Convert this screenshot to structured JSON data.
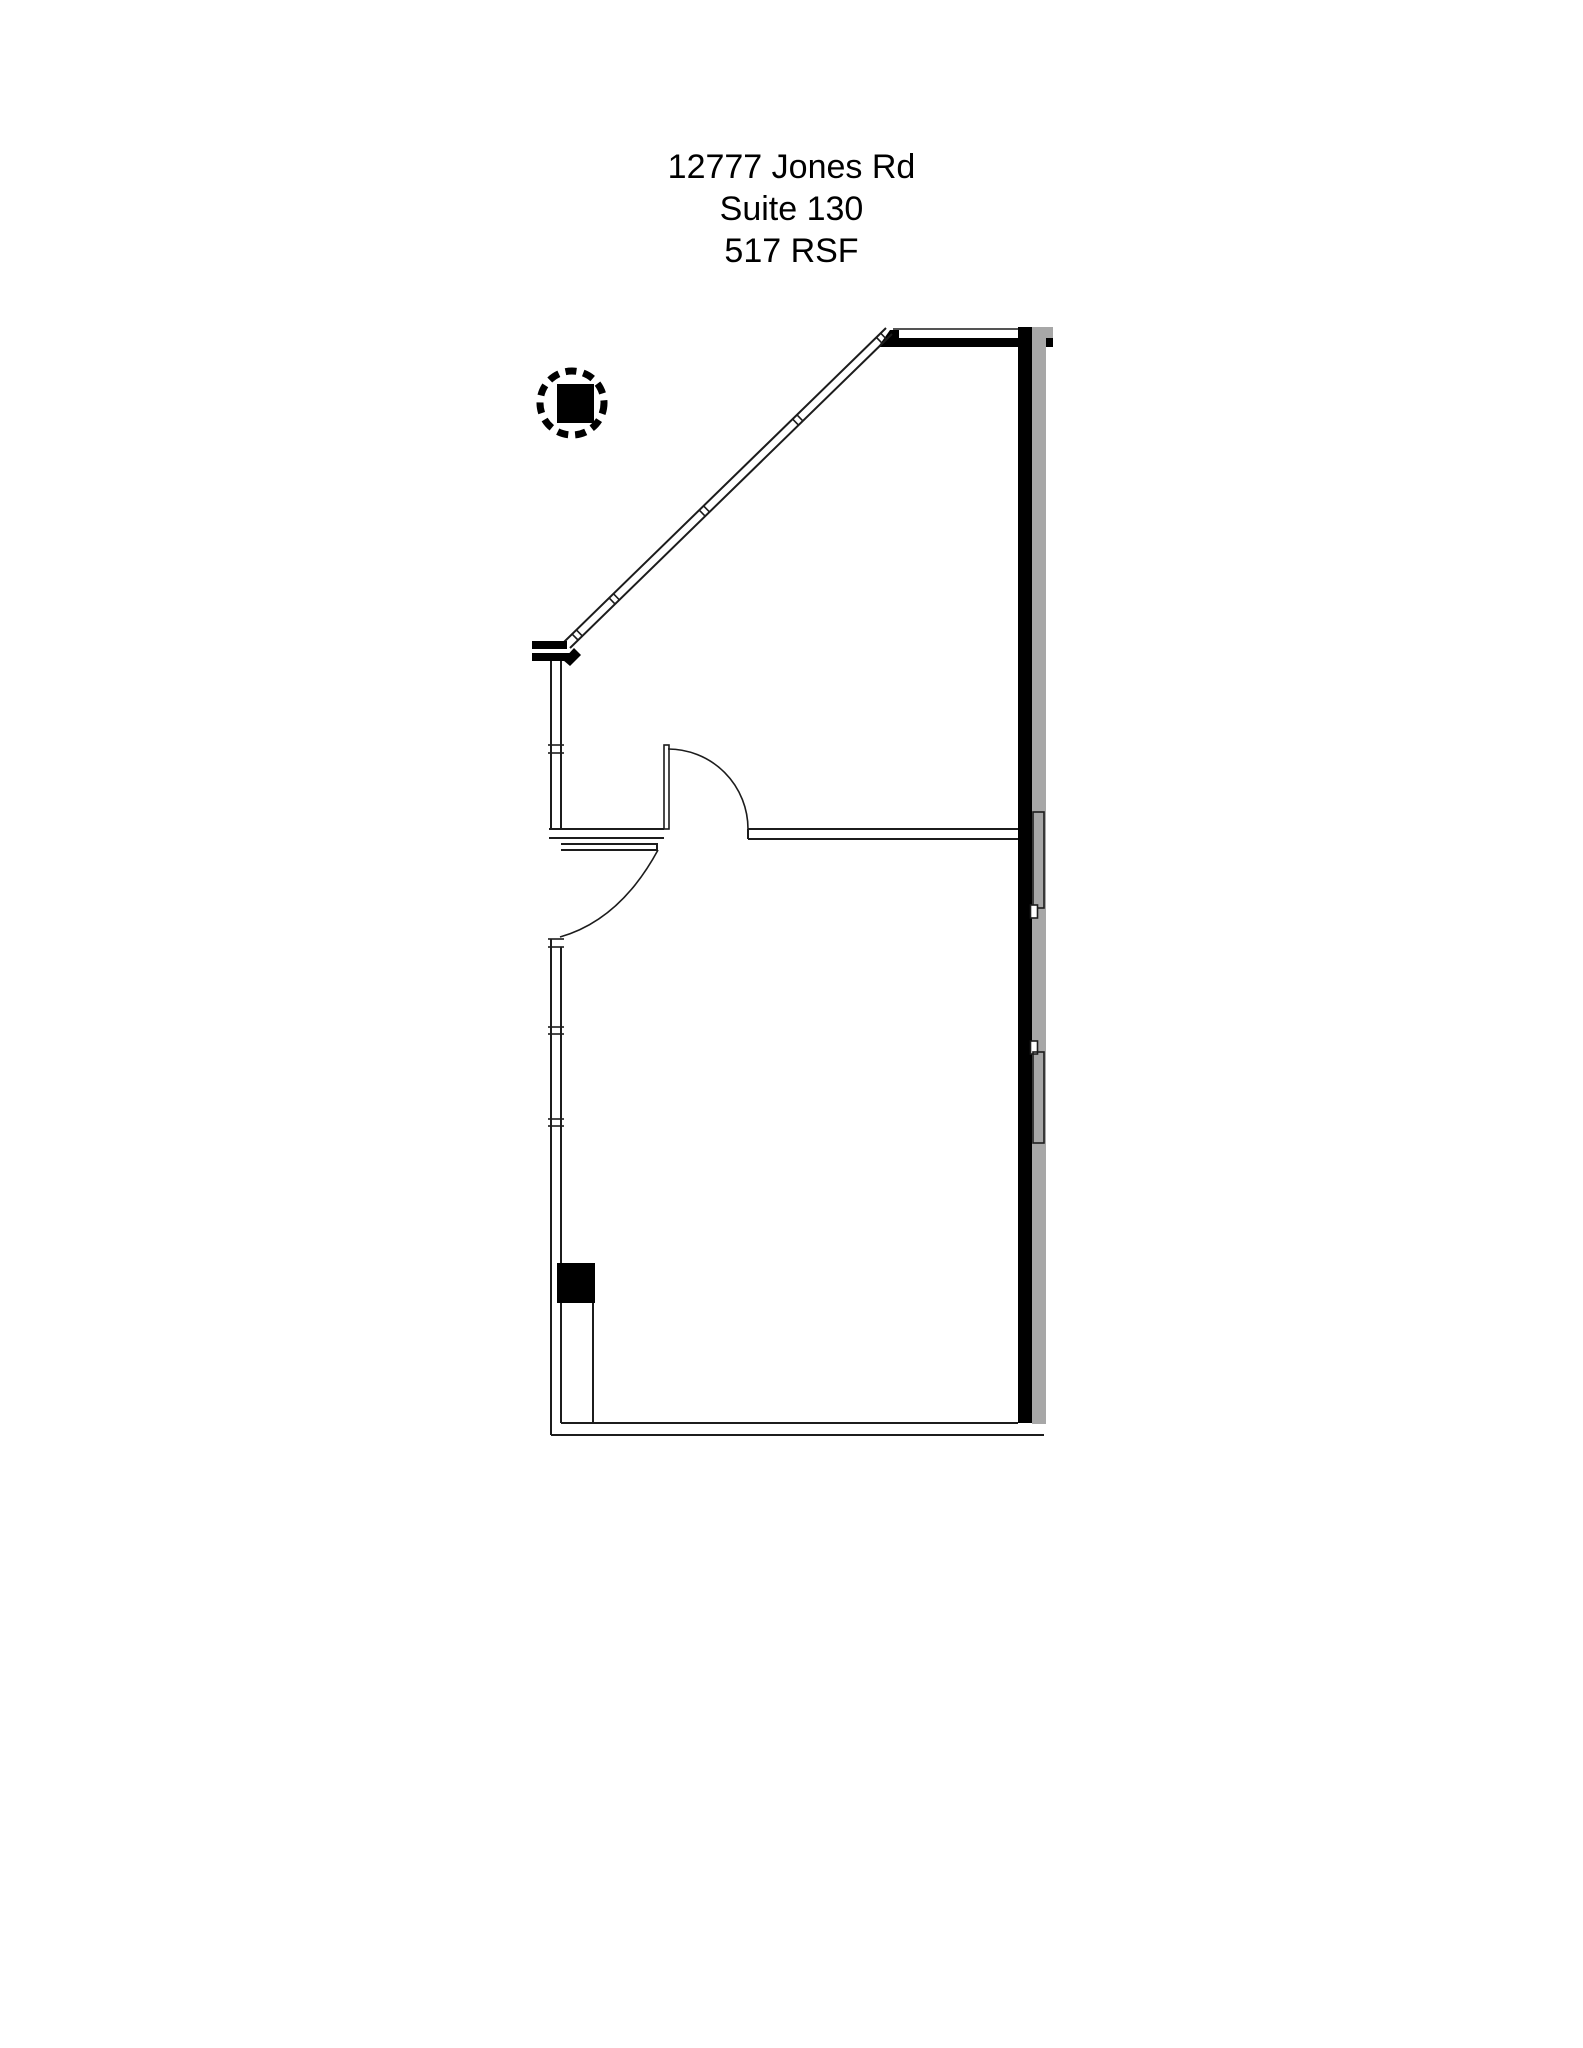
{
  "page": {
    "width": 1583,
    "height": 2048
  },
  "title_block": {
    "address": "12777 Jones Rd",
    "suite": "Suite 130",
    "area": "517 RSF"
  },
  "floor_plan": {
    "marker": "column-location-marker",
    "corridor": "shaded-corridor-band",
    "window_walls": [
      "diagonal-storefront-window",
      "north-window",
      "west-window-wall"
    ],
    "door_count": 2
  },
  "colors": {
    "wall_line": "#1c1c1c",
    "wall_fill": "#000000",
    "corridor_fill": "#a7a7a7",
    "background": "#ffffff"
  }
}
